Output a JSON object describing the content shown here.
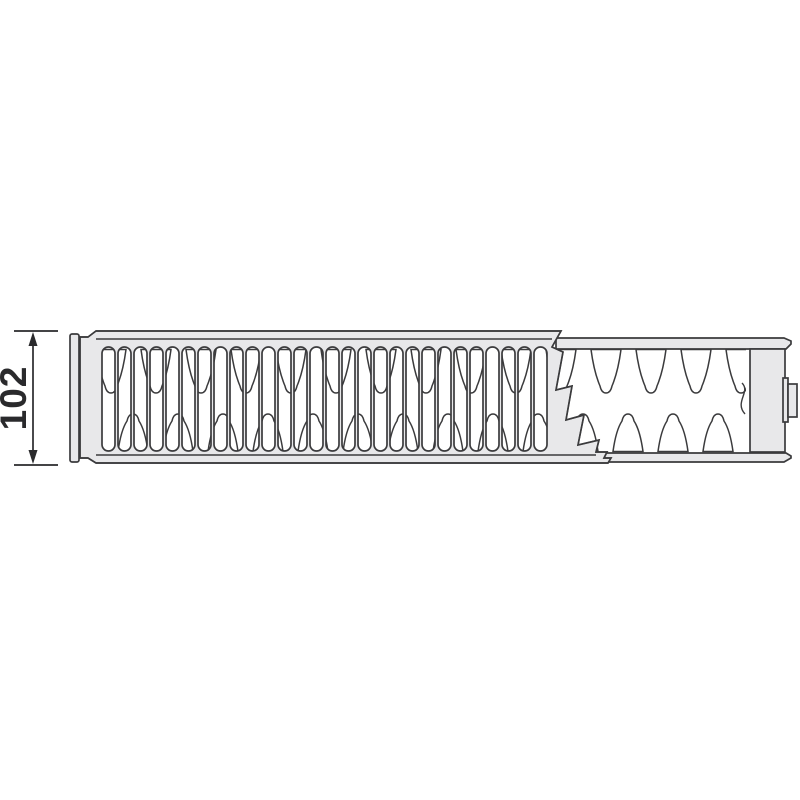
{
  "page": {
    "background": "#ffffff"
  },
  "diagram": {
    "dimension_label": "102",
    "colors": {
      "panel": "#e8e8ea",
      "outline": "#3b3b3d",
      "dimension": "#2a2a2c",
      "white": "#ffffff"
    },
    "grille": {
      "slot_count": 28,
      "first_slot_x": 102,
      "slot_pitch": 16,
      "slot_width": 13,
      "slot_top": 347,
      "slot_bottom": 451,
      "corner_radius": 6.5
    },
    "fins": {
      "count": 14,
      "start_x": 96,
      "period": 45,
      "bottom_row_offset": 22,
      "top_y": 349.5,
      "bottom_y": 451.5,
      "top_tip_y": 393,
      "bottom_tip_y": 414,
      "tongue_top_width": 30,
      "clip": {
        "x": 96,
        "y": 348,
        "width": 650,
        "height": 105
      }
    }
  }
}
